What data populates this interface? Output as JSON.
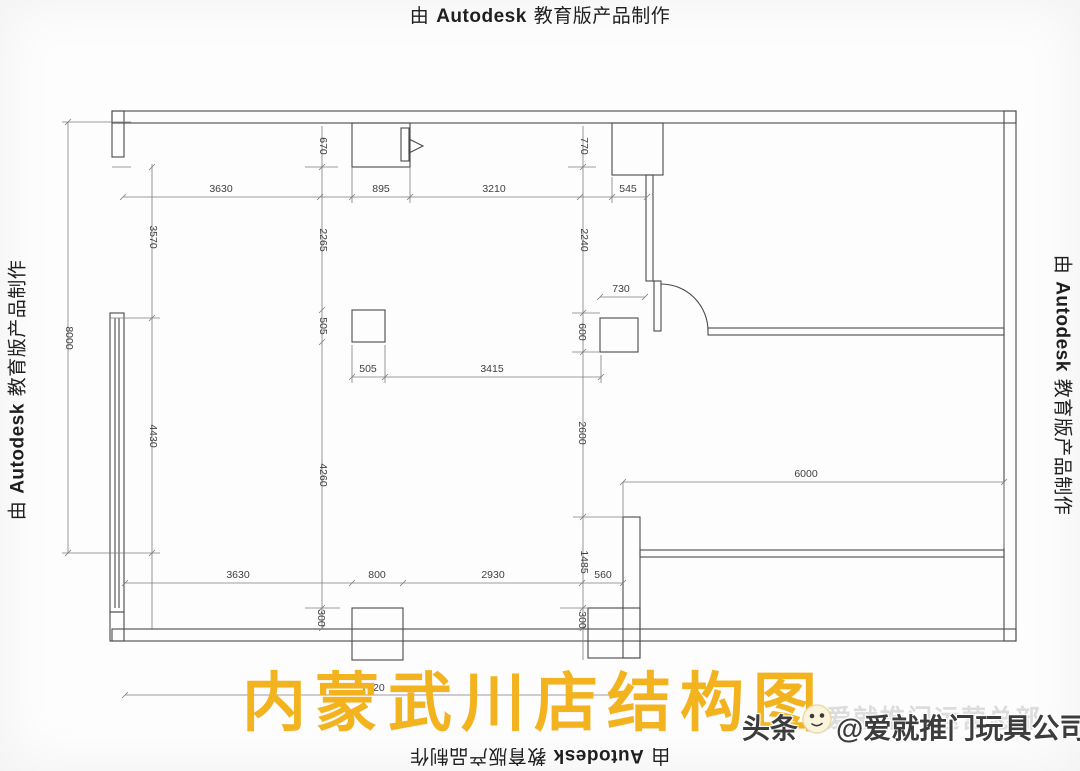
{
  "watermark": {
    "prefix": "由",
    "brand": "Autodesk",
    "suffix": "教育版产品制作"
  },
  "title_overlay": {
    "text": "内蒙武川店结构图",
    "color": "#f2b31e"
  },
  "byline": {
    "channel": "头条",
    "handle": "@爱就推门玩具公司",
    "ghost": "爱就推门运营总部",
    "icon": "toutiao-face-icon"
  },
  "plan": {
    "description": "store structure floor plan with dimension chains (mm)",
    "line_color": "#4a4a4a",
    "dim_color": "#3f3f3f",
    "dims": {
      "top_3630": "3630",
      "top_895": "895",
      "top_3210": "3210",
      "top_545": "545",
      "mid_730": "730",
      "mid_505_h": "505",
      "mid_3415": "3415",
      "right_6000": "6000",
      "bot_3630": "3630",
      "bot_800": "800",
      "bot_2930": "2930",
      "bot_560": "560",
      "bot_7320": "7320",
      "v_670": "670",
      "v_770": "770",
      "v_3570": "3570",
      "v_2265": "2265",
      "v_2240": "2240",
      "v_505": "505",
      "v_600": "600",
      "v_8000": "8000",
      "v_2600": "2600",
      "v_4430": "4430",
      "v_4260": "4260",
      "v_1485": "1485",
      "v_300_left": "300",
      "v_300_right": "300"
    }
  }
}
